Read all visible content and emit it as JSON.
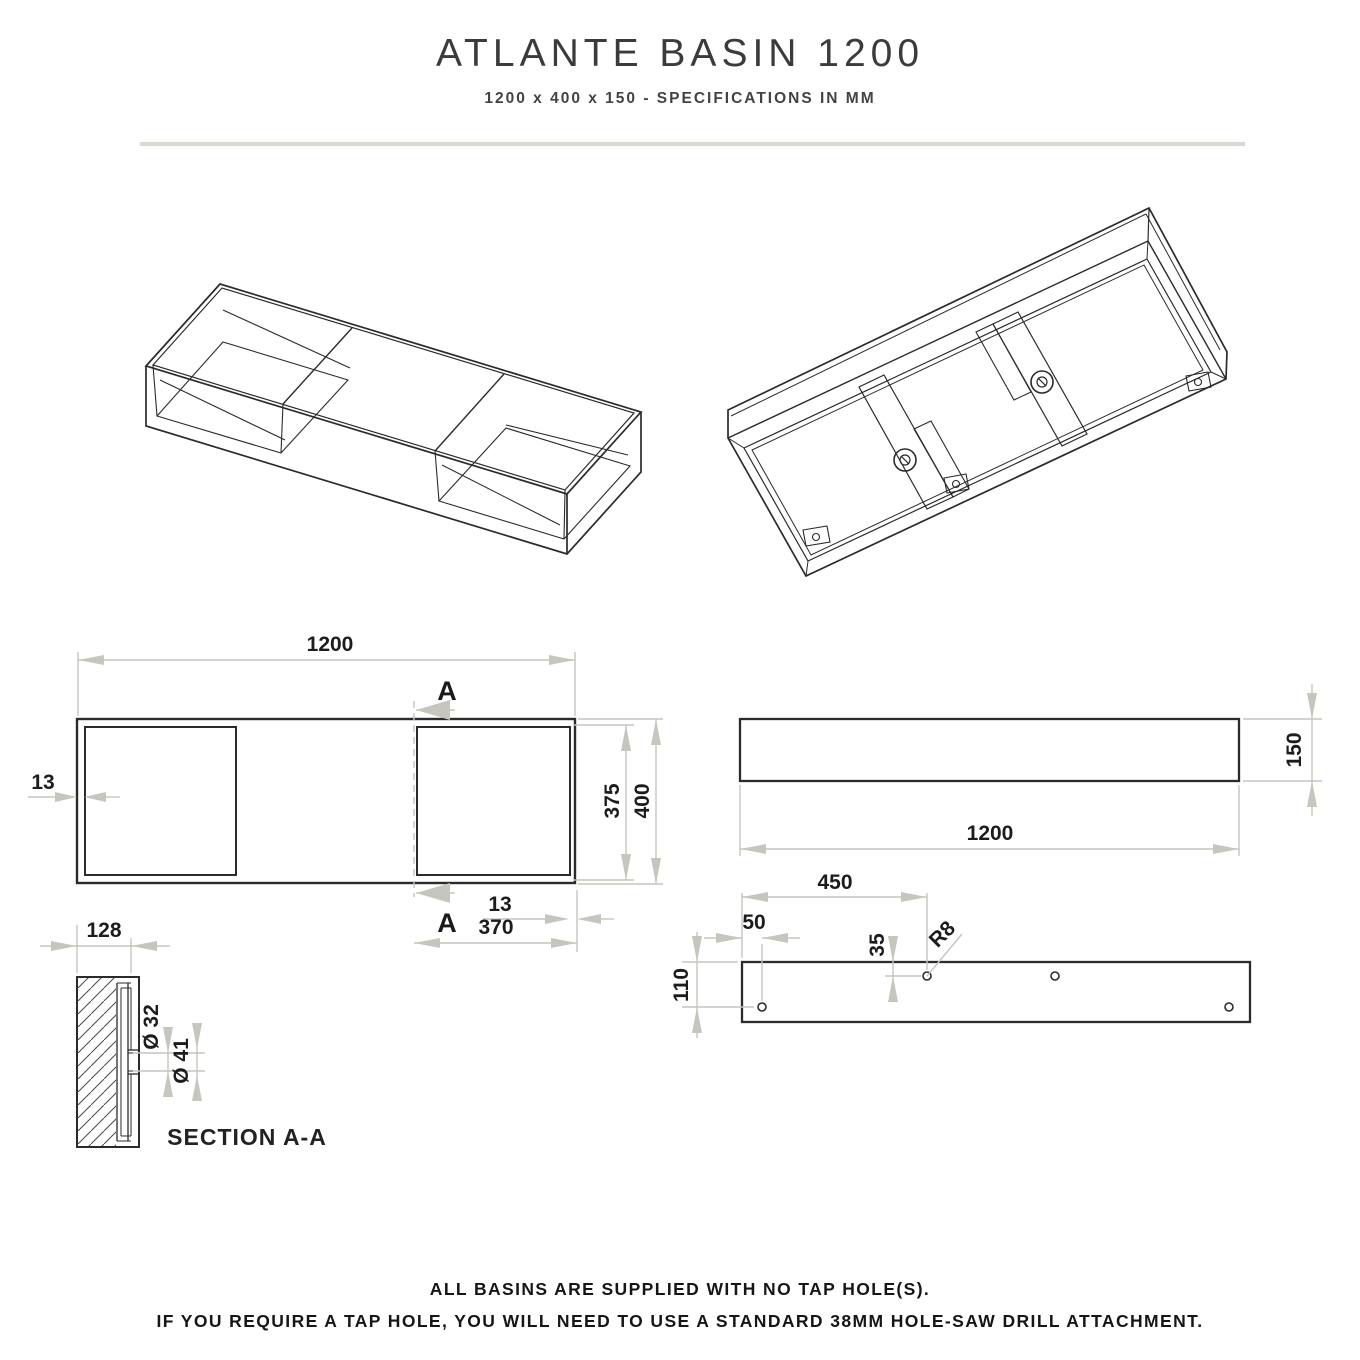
{
  "header": {
    "title": "ATLANTE BASIN 1200",
    "subtitle": "1200 x 400 x 150 - SPECIFICATIONS IN MM"
  },
  "plan": {
    "length": "1200",
    "inner_depth": "375",
    "outer_depth": "400",
    "wall_left": "13",
    "wall_right": "13",
    "basin_width": "370",
    "section_marker": "A"
  },
  "side": {
    "height": "150",
    "length": "1200"
  },
  "rear": {
    "hole_offset": "450",
    "edge_offset": "50",
    "top_offset": "35",
    "corner_radius": "R8",
    "bottom_offset": "110"
  },
  "section": {
    "width": "128",
    "drain_inner": "Ø 32",
    "drain_outer": "Ø 41",
    "label": "SECTION A-A"
  },
  "footer": {
    "line1": "ALL BASINS ARE SUPPLIED WITH NO TAP HOLE(S).",
    "line2": "IF YOU REQUIRE A TAP HOLE, YOU WILL NEED TO USE A STANDARD 38MM HOLE-SAW DRILL ATTACHMENT."
  }
}
